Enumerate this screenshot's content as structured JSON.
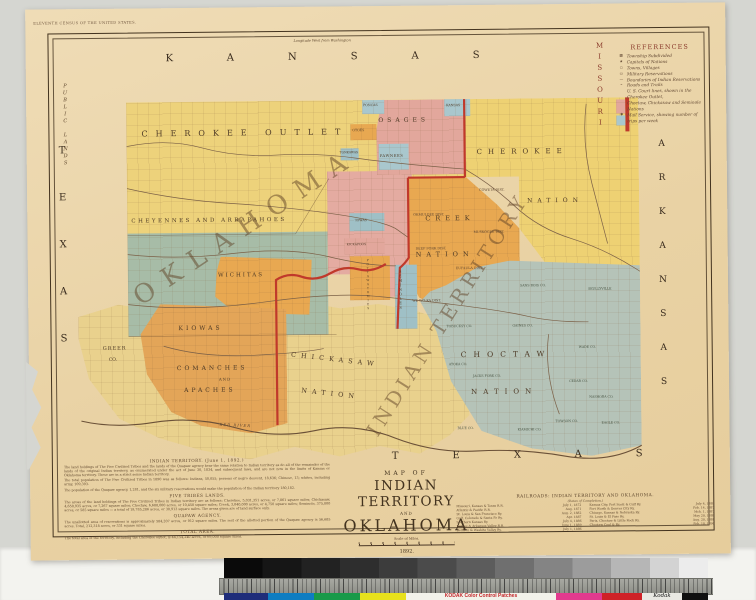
{
  "colors": {
    "backdrop": "#d5d6d1",
    "paper": "#ecd6ab",
    "outlet_yellow": "#edd27b",
    "cherokee_yellow": "#eed173",
    "pale_yellow": "#e9d18d",
    "creek_orange": "#e8a851",
    "kiowa_orange": "#e3a558",
    "oklahoma_pink": "#e4aba1",
    "osage_pink": "#e2a79c",
    "cheyenne_sage": "#a7bca7",
    "choctaw_sage": "#b5c3b8",
    "blue_patch": "#a9c7cd",
    "teal_patch": "#9fc0c6",
    "red_boundary": "#c0392b",
    "ink": "#43331f"
  },
  "paper": {
    "imprint": "ELEVENTH CENSUS OF THE UNITED STATES.",
    "longitude_note": "Longitude West from Washington"
  },
  "edges": {
    "kansas": "KANSAS",
    "missouri": "MISSOURI",
    "arkansas": "ARKANSAS",
    "texas_left": "TEXAS",
    "texas_bottom": "TEXAS",
    "public_lands": "PUBLIC LANDS"
  },
  "giant": {
    "oklahoma": "OKLAHOMA",
    "indian_territory": "INDIAN TERRITORY"
  },
  "regions": {
    "cherokee_outlet": "CHEROKEE OUTLET",
    "cheyenne_arapaho": "CHEYENNES AND ARRAPAHOES",
    "wichitas": "WICHITAS",
    "kiowas": "KIOWAS",
    "and": "AND",
    "comanches": "COMANCHES",
    "apaches": "APACHES",
    "greer": "GREER",
    "greer_co": "CO.",
    "osages": "OSAGES",
    "pawnees": "PAWNEES",
    "cherokee": "CHEROKEE",
    "cherokee_nation": "NATION",
    "creek": "CREEK",
    "creek_nation": "NATION",
    "choctaw": "CHOCTAW",
    "choctaw_nation": "NATION",
    "chickasaw": "CHICKASAW",
    "chickasaw_nation": "NATION",
    "seminoles": "SEMINOLES"
  },
  "tribes_small": {
    "poncas": "PONCAS",
    "otoes": "OTOES",
    "kaw": "KANSAS",
    "tonkawas": "TONKAWAS",
    "iowas": "IOWAS",
    "kickapoos": "KICKAPOOS",
    "pottawatomies": "POTTAWATOMIES"
  },
  "districts": {
    "coweta": "COWETA DIST.",
    "okmulgee": "OKMULGEE DIST.",
    "muskogee": "MUSKOGEE DIST.",
    "deep_fork": "DEEP FORK DIST.",
    "eufaula": "EUFAULA DIST.",
    "wewoka": "WE-WO-KA DIST."
  },
  "counties": {
    "sans_bois": "SANS BOIS CO.",
    "skullyville": "SKULLYVILLE",
    "gaines": "GAINES CO.",
    "tobucksy": "TOBUCKSY CO.",
    "atoka": "ATOKA CO.",
    "jacks_fork": "JACKS FORK CO.",
    "cedar": "CEDAR CO.",
    "wade": "WADE CO.",
    "nashoba": "NASHOBA CO.",
    "blue": "BLUE CO.",
    "kiamichi": "KIAMICHI CO.",
    "towson": "TOWSON CO.",
    "eagle": "EAGLE CO."
  },
  "rivers": {
    "red_river": "RED RIVER"
  },
  "references": {
    "title": "REFERENCES",
    "items": [
      {
        "sym": "▦",
        "label": "Township Subdivided"
      },
      {
        "sym": "★",
        "label": "Capitals of Nations"
      },
      {
        "sym": "○",
        "label": "Towns, Villages"
      },
      {
        "sym": "▭",
        "label": "Military Reservations"
      },
      {
        "sym": "—",
        "label": "Boundaries of Indian Reservations"
      },
      {
        "sym": "⌁",
        "label": "Roads and Trails"
      },
      {
        "sym": "",
        "label": "U. S. Court lines, shown in the Cherokee Outlet,"
      },
      {
        "sym": "",
        "label": "Choctaw, Chickasaw and Seminole Nations"
      },
      {
        "sym": "✱",
        "label": "Mail Service, showing number of trips per week"
      }
    ]
  },
  "title_block": {
    "map_of": "MAP OF",
    "line1": "INDIAN TERRITORY",
    "and": "AND",
    "line2": "OKLAHOMA",
    "scale": "Scale of Miles.",
    "year": "1892.",
    "compiled": "Compiled at the Census Office, Washington, D. C."
  },
  "notes": {
    "h1": "INDIAN TERRITORY.  (June 1, 1892.)",
    "p1": "The land holdings of The Five Civilized Tribes and the lands of the Quapaw agency bear the same relation to Indian territory as do all of the remainder of the lands of the original Indian territory, as enumerated under the act of June 30, 1834, and subsequent laws, and are not now in the limits of Kansas or Oklahoma territory. These are in a strict sense Indian territory.",
    "p2": "The total population of The Five Civilized Tribes in 1890 was as follows: Indians, 50,055; persons of negro descent, 18,636; Chinese, 13; whites, including army, 109,393.",
    "p3": "The population of the Quapaw agency, 1,281, and the six military reservations would make the population of the Indian territory 180,182.",
    "h2": "FIVE TRIBES LANDS.",
    "p4": "The areas of the land holdings of The Five Civilized Tribes in Indian territory are as follows: Cherokee, 5,031,351 acres, or 7,861 square miles; Chickasaw, 4,650,935 acres, or 7,267 square miles; Choctaw, 6,688,000 acres, or 10,450 square miles; Creek, 3,040,000 acres, or 4,750 square miles; Seminole, 375,000 acres, or 585 square miles — a total of 19,785,286 acres, or 30,913 square miles. The areas given are of land surface only.",
    "h3": "QUAPAW AGENCY.",
    "p5": "The unallotted area of reservations is approximately 584,207 acres, or 912 square miles. The rest of the allotted portion of the Quapaw agency is 56,685 acres. Total, 212,318 acres, or 331 square miles.",
    "h4": "TOTAL AREA.",
    "p6": "The total area of the territory, including the Cherokee outlet, is 44,154,240 acres, or 69,000 square miles."
  },
  "railroads": {
    "title": "RAILROADS: INDIAN TERRITORY AND OKLAHOMA.",
    "subtitle": "(Dates of Completion.)",
    "left": [
      {
        "name": "Missouri, Kansas & Texas R.R.",
        "date": "July 1, 1872"
      },
      {
        "name": "Atlantic & Pacific R.R.",
        "date": "Aug. 1871"
      },
      {
        "name": "St. Louis & San Francisco Ry.",
        "date": "Aug. 2, 1882"
      },
      {
        "name": "Gulf, Colorado & Santa Fe Ry.",
        "date": "Apr. 1887"
      },
      {
        "name": "Southern Kansas Ry.",
        "date": "July 4, 1886"
      },
      {
        "name": "Kansas & Arkansas Valley R.R.",
        "date": "June 1, 1889"
      },
      {
        "name": "Denison & Washita Valley Ry.",
        "date": "July 1, 1886"
      }
    ],
    "right": [
      {
        "name": "Kansas City, Fort Scott & Gulf Ry.",
        "date": "July 4, 1888"
      },
      {
        "name": "Fort Worth & Denver City Ry.",
        "date": "Feb. 14, 1887"
      },
      {
        "name": "Chicago, Kansas & Nebraska Ry.",
        "date": "Mch. 1, 1887"
      },
      {
        "name": "St. Louis & El Paso Ry.",
        "date": "May 20, 1888"
      },
      {
        "name": "Paris, Choctaw & Little Rock Ry.",
        "date": "Aug. 20, 1888"
      },
      {
        "name": "Choctaw Coal & Ry.",
        "date": "Feb. 10, 1890"
      }
    ]
  },
  "kodak": {
    "title": "KODAK Color Control Patches",
    "brand": "Kodak",
    "patches": [
      "#1f2d7a",
      "#0e7dc2",
      "#199a49",
      "#e7e11c",
      "#e23a8e",
      "#cf2127"
    ]
  }
}
